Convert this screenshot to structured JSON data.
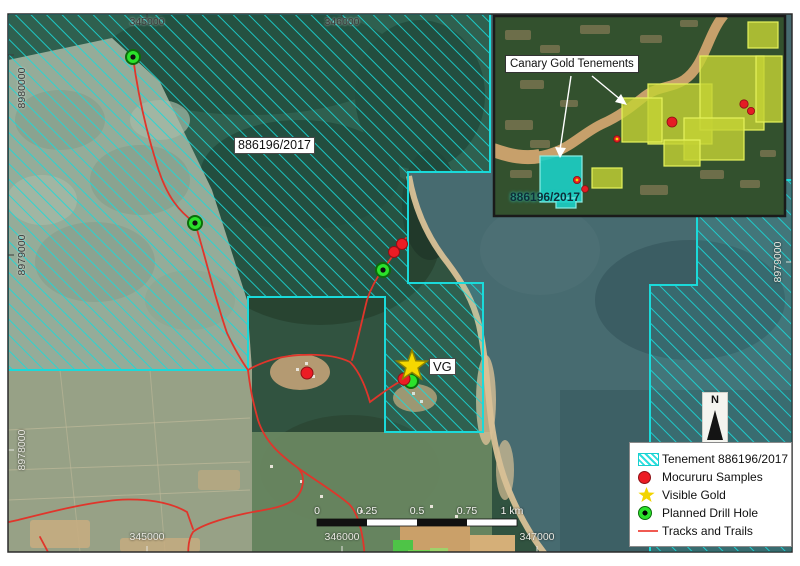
{
  "map": {
    "tenement_label": "886196/2017",
    "vg_label": "VG",
    "grid": {
      "top": [
        "345000",
        "346000"
      ],
      "bottom": [
        "345000",
        "346000",
        "347000"
      ],
      "left": [
        "8980000",
        "8979000",
        "8978000"
      ],
      "right": [
        "8979000"
      ]
    }
  },
  "scalebar": {
    "labels": [
      "0",
      "0.25",
      "0.5",
      "0.75",
      "1 km"
    ]
  },
  "north_arrow": {
    "label": "N"
  },
  "inset": {
    "callout_label": "Canary Gold Tenements",
    "tenement_label": "886196/2017"
  },
  "legend": {
    "items": [
      {
        "icon": "tenement-swatch",
        "label": "Tenement  886196/2017"
      },
      {
        "icon": "sample-dot",
        "label": "Mocururu Samples"
      },
      {
        "icon": "gold-star",
        "label": "Visible Gold"
      },
      {
        "icon": "drill-hole",
        "label": "Planned Drill Hole"
      },
      {
        "icon": "track-line",
        "label": "Tracks and Trails"
      }
    ]
  },
  "colors": {
    "tenement_cyan": "#1adada",
    "sample_red": "#ec1c24",
    "gold_yellow": "#f6d800",
    "drill_green": "#2be22b",
    "track_red": "#e0352b",
    "water": "#476b70"
  }
}
